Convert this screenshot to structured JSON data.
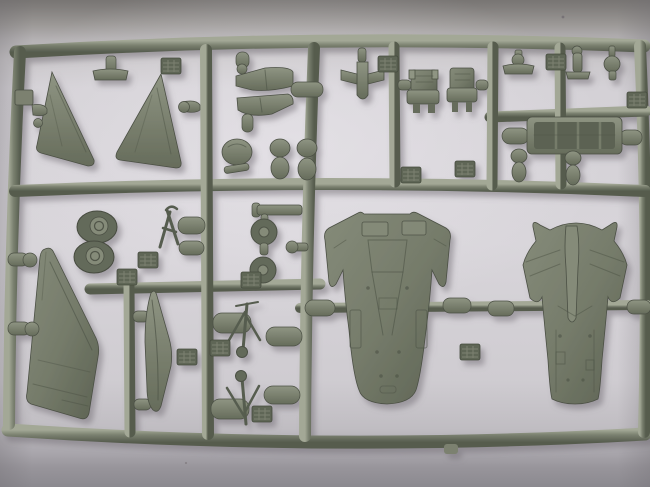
{
  "scene": {
    "type": "photograph",
    "subject": "grey injection-moulded plastic model-kit sprue (parts runner) of a delta-wing jet aircraft, unassembled parts still attached",
    "background": "plain pale grey studio surface, darker bands at top and bottom edges, soft vignette",
    "text_visible": "none"
  },
  "palette": {
    "bg_center": "#d8d5da",
    "bg_top_band": "#787573",
    "bg_bottom_band": "#8b898f",
    "plastic_highlight": "#a3a896",
    "plastic_mid": "#7b8170",
    "plastic_dark": "#565c4e",
    "plastic_shadow_line": "#4b5044",
    "part_hi": "#8f9583",
    "part_lo": "#666c5b",
    "bigpart_hi": "#858b79",
    "bigpart_mid": "#767c6b",
    "bigpart_lo": "#5d6353",
    "panel_line": "#4d5346",
    "wire": "#575d4f",
    "tire": "#646a5a",
    "pad": "#5f6657",
    "pad_ridge": "#8a9180",
    "interior": "#5c6253",
    "cast_shadow": "#6f6a72"
  },
  "parts": [
    {
      "name": "sprue-frame",
      "desc": "outer rectangular runner frame with internal cross runners"
    },
    {
      "name": "wing-half-left",
      "desc": "delta wing panel, left"
    },
    {
      "name": "wing-half-right",
      "desc": "delta wing panel, right"
    },
    {
      "name": "intake-upper",
      "desc": "air intake half, upper"
    },
    {
      "name": "intake-lower",
      "desc": "air intake half, lower"
    },
    {
      "name": "finned-store",
      "desc": "small finned store / dart-shaped part"
    },
    {
      "name": "ejection-seat-1",
      "desc": "ejection seat"
    },
    {
      "name": "ejection-seat-2",
      "desc": "ejection seat"
    },
    {
      "name": "cockpit-tub",
      "desc": "long rectangular cockpit tub / tray"
    },
    {
      "name": "main-wheel-pair",
      "desc": "two joined main wheels with hub detail"
    },
    {
      "name": "nose-wheel-stack",
      "desc": "two small round wheels on a stem"
    },
    {
      "name": "tow-bar",
      "desc": "thin A-frame wire part"
    },
    {
      "name": "vertical-fin",
      "desc": "large swept vertical tail fin"
    },
    {
      "name": "tank-half-blade",
      "desc": "long slender drop-tank half"
    },
    {
      "name": "landing-gear-leg-1",
      "desc": "landing gear strut with braces"
    },
    {
      "name": "landing-gear-leg-2",
      "desc": "landing gear strut with braces"
    },
    {
      "name": "fuselage-bottom-half",
      "desc": "large lower fuselage half with wheel wells and panel lines"
    },
    {
      "name": "fuselage-top-half",
      "desc": "large upper fuselage half with spine and wing roots"
    },
    {
      "name": "molding-pads",
      "desc": "small textured ejector pads scattered on runners"
    },
    {
      "name": "attachment-stubs",
      "desc": "round-nosed connector stubs joining parts to runners"
    }
  ]
}
